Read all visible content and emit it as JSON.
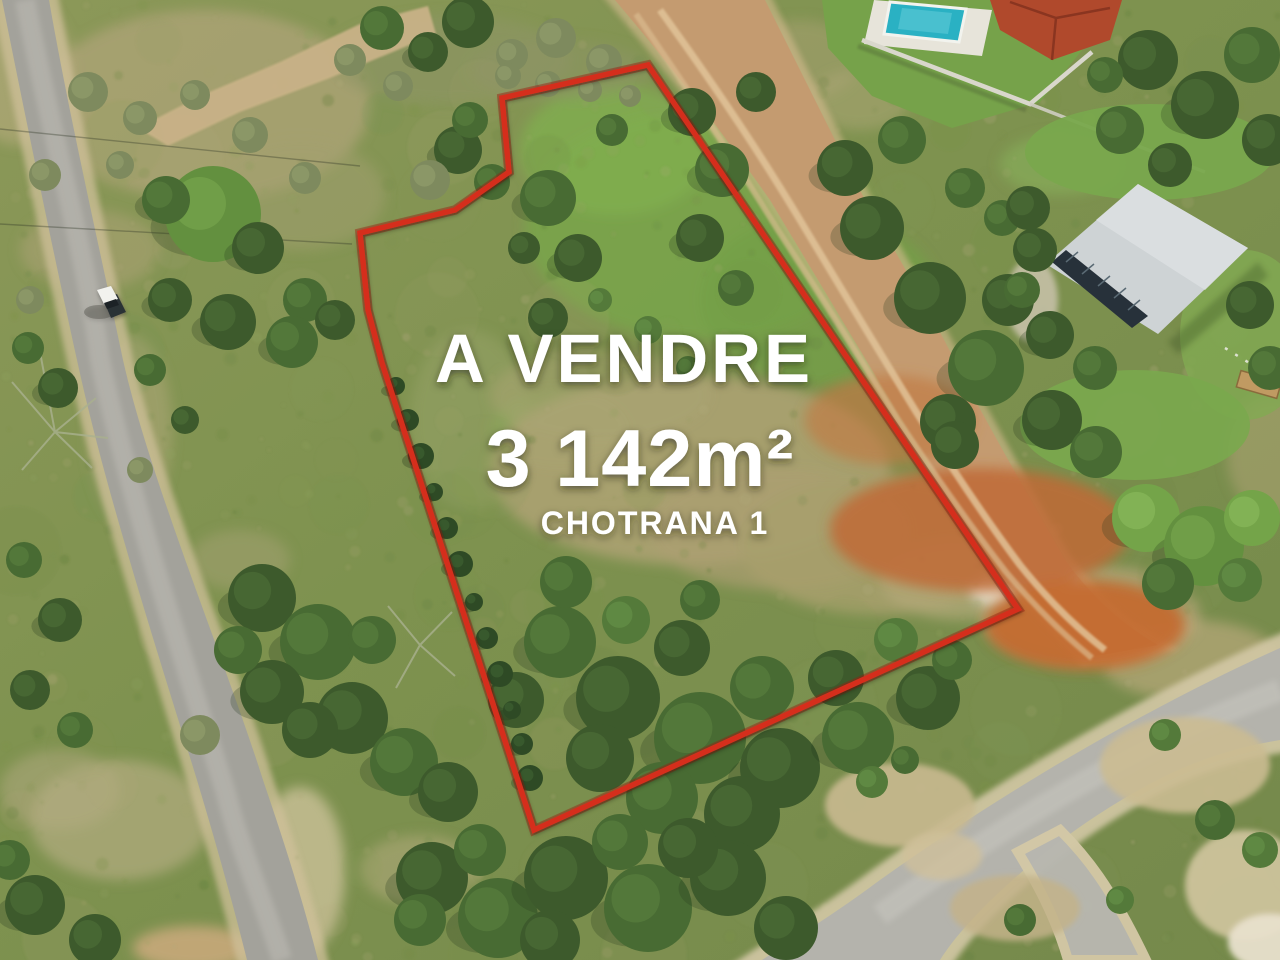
{
  "overlay": {
    "title": "A VENDRE",
    "area": "3 142m²",
    "location": "CHOTRANA 1",
    "text_color": "#ffffff",
    "boundary_color": "#d52f1d"
  },
  "plot": {
    "boundary_points": "502,98 509,172 455,210 360,233 368,310 382,363 534,830 1018,609 648,65"
  },
  "scene": {
    "pool_color": "#2ab1c3",
    "villa_roof_color": "#b0492c",
    "warehouse_roof_color": "#ced3d5",
    "dirt_road_color": "#c49b70",
    "asphalt_color": "#a3a29b"
  }
}
